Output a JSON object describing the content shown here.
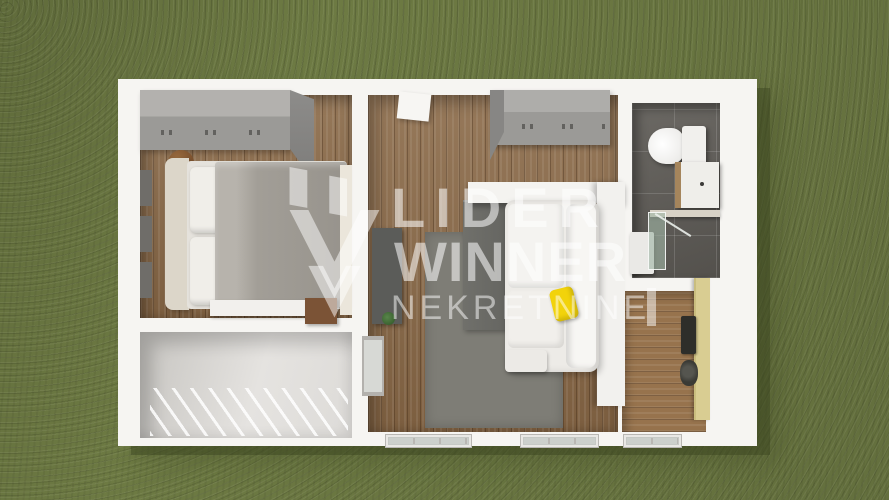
{
  "watermark": {
    "line1": "LIDER",
    "line2": "WINNER",
    "line3": "NEKRETNINE",
    "logo": "double-chevron-mark"
  },
  "colors": {
    "grass": "#6d7a43",
    "wall": "#f6f5f2",
    "wood": "#8a6947",
    "wood_light": "#97734d",
    "tile": "#5f5c57",
    "rug": "#7e7d76",
    "furniture_gray": "#9b9a97",
    "sofa": "#edebe7",
    "pillow_yellow": "#f2d30b",
    "door_cream": "#d9cd92",
    "shower_glass": "#a0b4a5",
    "watermark": "rgba(255,255,255,0.55)"
  },
  "scene": {
    "type": "3d-floorplan-top-view",
    "rooms": [
      {
        "name": "bedroom",
        "furniture": [
          "wardrobe",
          "double-bed",
          "pillows",
          "wall-art",
          "night-stool",
          "foot-bench"
        ]
      },
      {
        "name": "living-room",
        "furniture": [
          "wardrobe",
          "tv-panel",
          "plant",
          "rug",
          "dark-table",
          "corner-sofa",
          "yellow-pillow",
          "partition-wall",
          "door"
        ]
      },
      {
        "name": "bathroom",
        "furniture": [
          "toilet",
          "vanity-sink",
          "shower-tray",
          "shower-glass"
        ]
      },
      {
        "name": "hallway-kitchenette",
        "furniture": [
          "entrance-door",
          "kitchen-panel",
          "sink"
        ]
      },
      {
        "name": "terrace",
        "furniture": [
          "deck-stripes"
        ]
      }
    ]
  }
}
